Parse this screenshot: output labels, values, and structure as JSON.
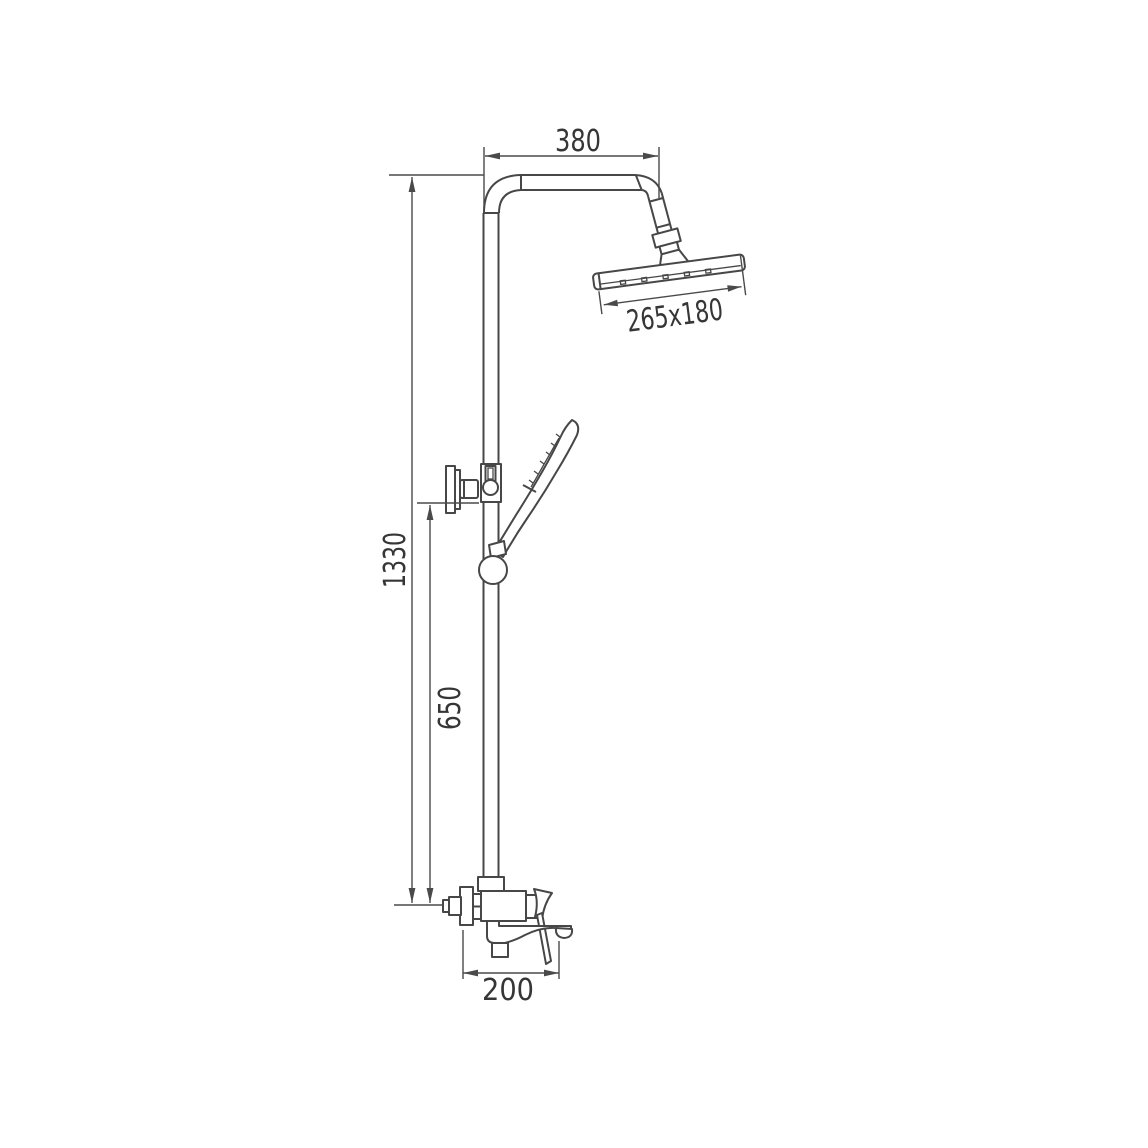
{
  "colors": {
    "background": "#ffffff",
    "line_ink": "#474747",
    "text_ink": "#363636"
  },
  "labels": {
    "top_arm_width": "380",
    "head_size": "265x180",
    "total_height": "1330",
    "slide_bar_height": "650",
    "spout_reach": "200"
  }
}
